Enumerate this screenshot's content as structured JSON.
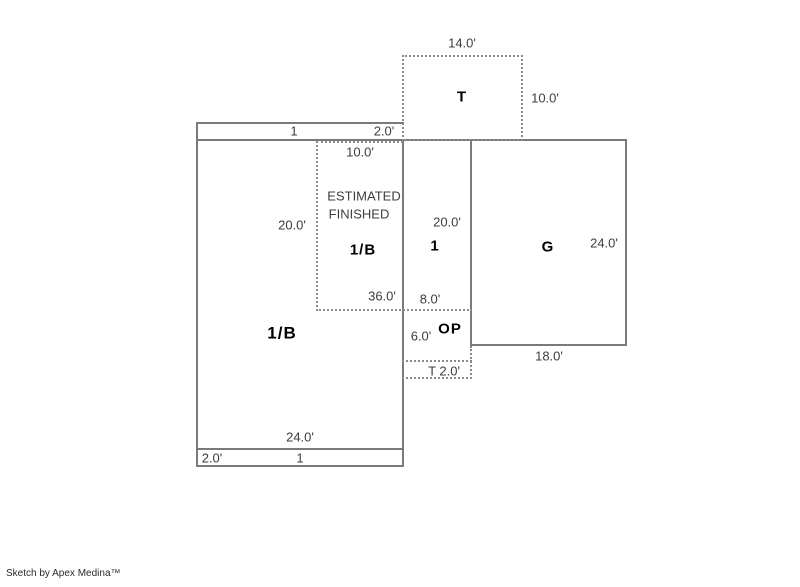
{
  "watermark": "Sketch by Apex Medina™",
  "colors": {
    "background": "#ffffff",
    "solid_line": "#7a7a7a",
    "dashed_line": "#8a8a8a",
    "dimension_text": "#3d3d3d",
    "area_label_text": "#000000"
  },
  "areas": {
    "t_box": {
      "label": "T",
      "width": "14.0'",
      "height": "10.0'"
    },
    "top_strip": {
      "label": "1",
      "depth": "2.0'"
    },
    "estimated_box": {
      "note_line1": "ESTIMATED",
      "note_line2": "FINISHED",
      "label": "1/B",
      "width_top": "10.0'",
      "height": "20.0'",
      "bottom_dim": "36.0'"
    },
    "region_one": {
      "label": "1",
      "height": "20.0'",
      "width_bottom": "8.0'"
    },
    "garage": {
      "label": "G",
      "height": "24.0'",
      "width": "18.0'"
    },
    "open_porch": {
      "label": "OP",
      "height": "6.0'"
    },
    "t_strip": {
      "label": "T 2.0'"
    },
    "main_region": {
      "label": "1/B",
      "width": "24.0'"
    },
    "bottom_strip": {
      "label": "1",
      "depth": "2.0'"
    }
  }
}
